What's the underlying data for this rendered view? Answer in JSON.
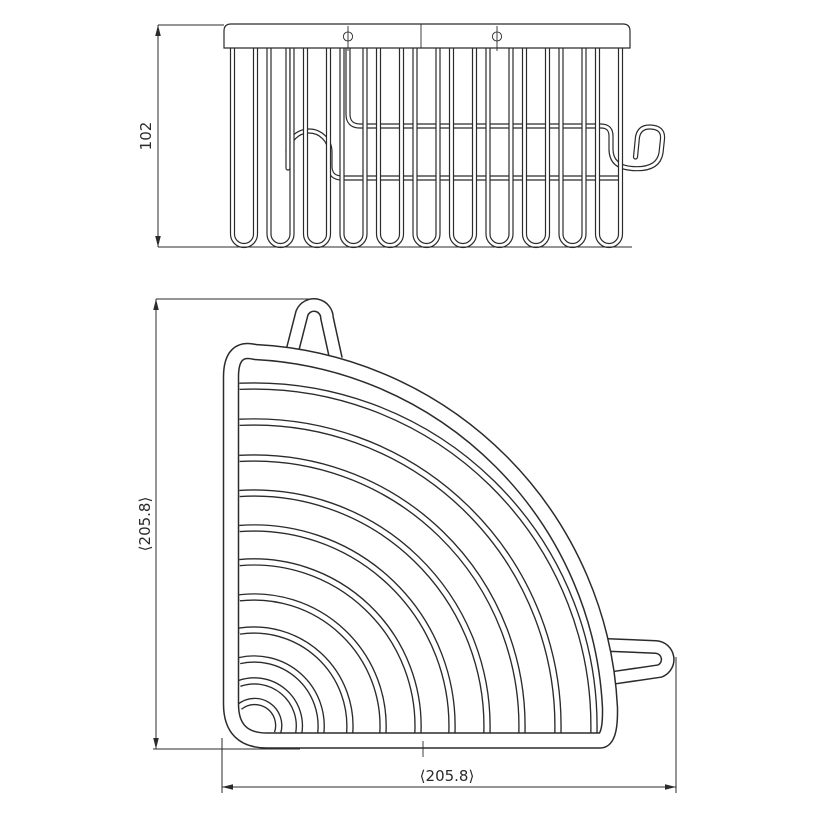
{
  "drawing": {
    "side_view": {
      "height_label": "102"
    },
    "plan_view": {
      "vertical_label": "⟨205.8⟩",
      "horizontal_label": "⟨205.8⟩"
    },
    "colors": {
      "line": "#2b2b2b",
      "background": "#ffffff"
    }
  }
}
